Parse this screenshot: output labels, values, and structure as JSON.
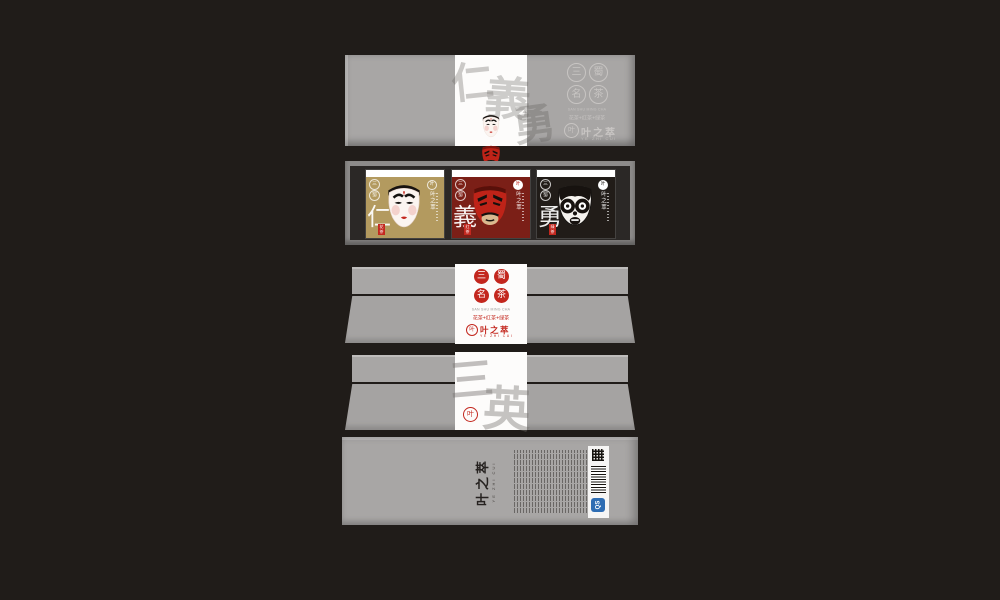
{
  "artboard": {
    "bg": "#201c19",
    "panel_gray": "#a8a6a5",
    "accent_red": "#c3271e"
  },
  "brand": {
    "name": "叶之萃",
    "name_sub": "YE ZHI CUI",
    "logo_glyph": "叶",
    "seal_chars": [
      "三",
      "蜀",
      "名",
      "茶"
    ],
    "tagline_en": "SAN SHU MING CHA",
    "tagline_cn": "花茶+红茶+绿茶"
  },
  "lid_panel": {
    "watermark_chars": [
      "仁",
      "義",
      "勇"
    ],
    "side_tag": "三国茶"
  },
  "tray_panel": {
    "cards": [
      {
        "virtue": "仁",
        "tag": "花茶",
        "bg": "#b39a5f",
        "mask": "white-face"
      },
      {
        "virtue": "義",
        "tag": "红茶",
        "bg": "#7b1f17",
        "mask": "red-face"
      },
      {
        "virtue": "勇",
        "tag": "绿茶",
        "bg": "#211c18",
        "mask": "black-face"
      }
    ]
  },
  "back_panel": {
    "watermark_chars": [
      "三",
      "英"
    ]
  },
  "bottom_panel": {
    "brand": "叶之萃",
    "brand_sub": "YE ZHI CUI",
    "qs_label": "QS"
  }
}
